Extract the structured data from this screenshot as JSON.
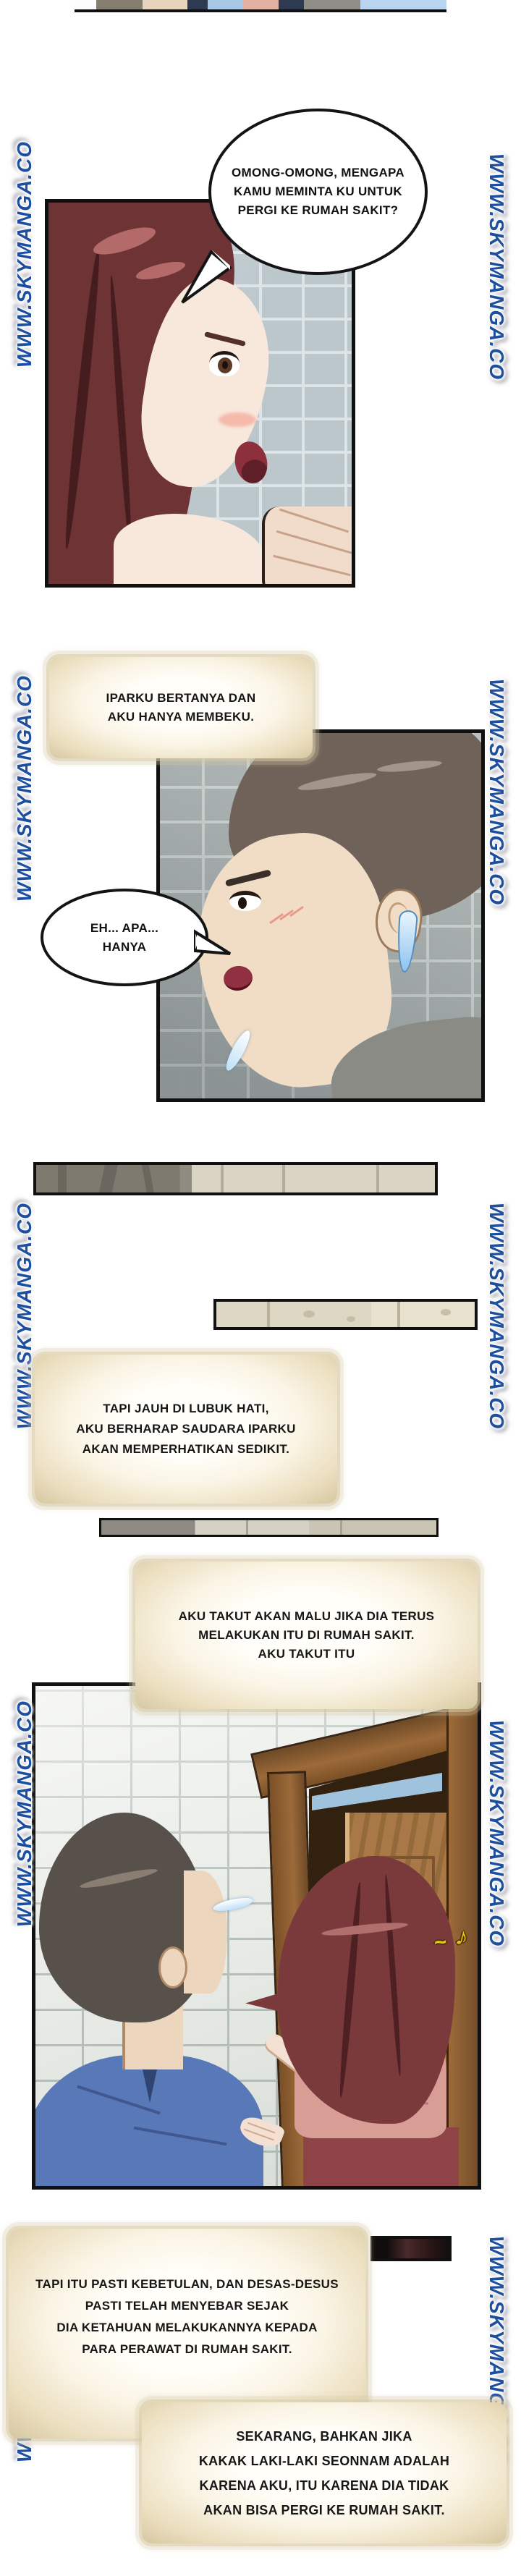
{
  "watermark": {
    "text": "WWW.SKYMANGA.CO",
    "color": "#1d4fa1"
  },
  "bubbles": {
    "b1": {
      "lines": [
        "OMONG-OMONG, MENGAPA",
        "KAMU MEMINTA KU UNTUK",
        "PERGI KE RUMAH SAKIT?"
      ]
    },
    "b2": {
      "lines": [
        "EH... APA...",
        "HANYA"
      ]
    }
  },
  "narrations": {
    "n1": {
      "lines": [
        "IPARKU BERTANYA DAN",
        "AKU HANYA MEMBEKU."
      ]
    },
    "n2": {
      "lines": [
        "TAPI JAUH DI LUBUK HATI,",
        "AKU BERHARAP SAUDARA IPARKU",
        "AKAN MEMPERHATIKAN SEDIKIT."
      ]
    },
    "n3": {
      "lines": [
        "AKU TAKUT AKAN MALU JIKA DIA TERUS",
        "MELAKUKAN ITU DI RUMAH SAKIT.",
        "AKU TAKUT ITU"
      ]
    },
    "n4": {
      "lines": [
        "TAPI ITU PASTI KEBETULAN, DAN DESAS-DESUS",
        "PASTI TELAH MENYEBAR SEJAK",
        "DIA KETAHUAN MELAKUKANNYA KEPADA",
        "PARA PERAWAT DI RUMAH SAKIT."
      ]
    },
    "n5": {
      "lines": [
        "SEKARANG, BAHKAN JIKA",
        "KAKAK LAKI-LAKI SEONNAM ADALAH",
        "KARENA AKU, ITU KARENA DIA TIDAK",
        "AKAN BISA PERGI KE RUMAH SAKIT."
      ]
    }
  },
  "sfx": {
    "music_note": "♪",
    "squiggle": "~"
  },
  "colors": {
    "watermark_blue": "#1d4fa1",
    "panel_border": "#101010",
    "narration_tan": "#d6c7a0",
    "wall_blue_grey": "#bcc7cc",
    "wall_grey": "#a6adad",
    "tile_white": "#e9ece7",
    "hair_red": "#6e3335",
    "hair_brown": "#6f6259",
    "hair_dark": "#57504b",
    "skin": "#f6e3d4",
    "shirt_blue": "#5878b8",
    "blouse_pink": "#d89d95",
    "skirt_maroon": "#8e4347",
    "door_wood": "#9c6a3a",
    "sweat_blue": "#8ec4ee",
    "sky_blue": "#9fc3dc"
  }
}
